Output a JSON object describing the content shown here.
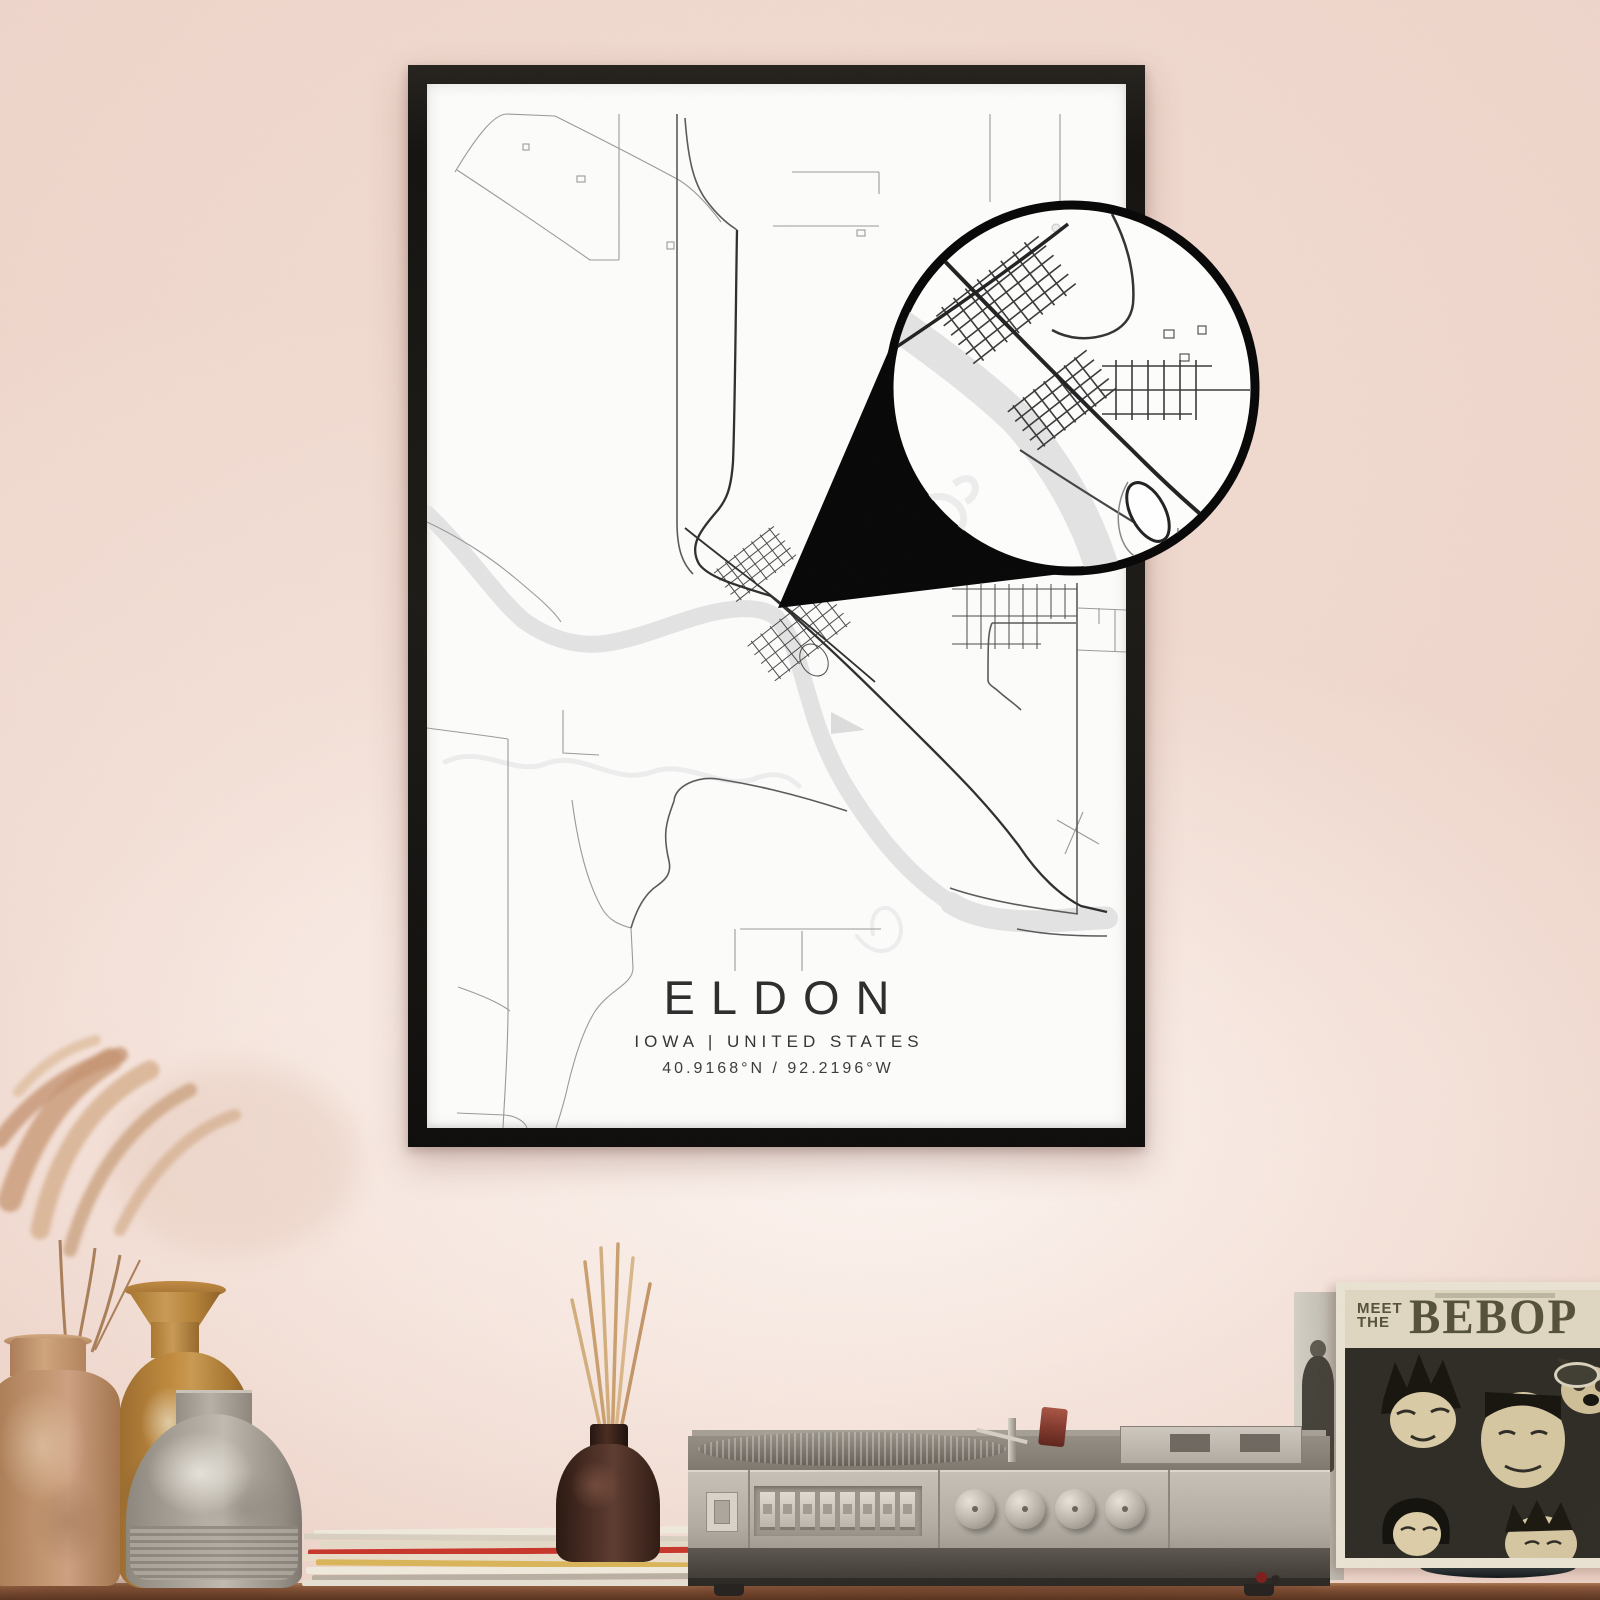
{
  "poster": {
    "title": "ELDON",
    "subtitle": "IOWA | UNITED STATES",
    "coordinates": "40.9168°N / 92.2196°W",
    "frame_color": "#17150f",
    "paper_color": "#fcfcfb",
    "road_color": "#4a4a4a",
    "river_color": "#e3e3e3",
    "magnifier_border_color": "#070707"
  },
  "wall": {
    "base_color": "#ecd2c7",
    "highlight_color": "#f7ece6"
  },
  "shelf": {
    "wood_color": "#73452c"
  },
  "album": {
    "title_word1": "MEET",
    "title_word2": "THE",
    "title_word3": "BEBOP"
  }
}
